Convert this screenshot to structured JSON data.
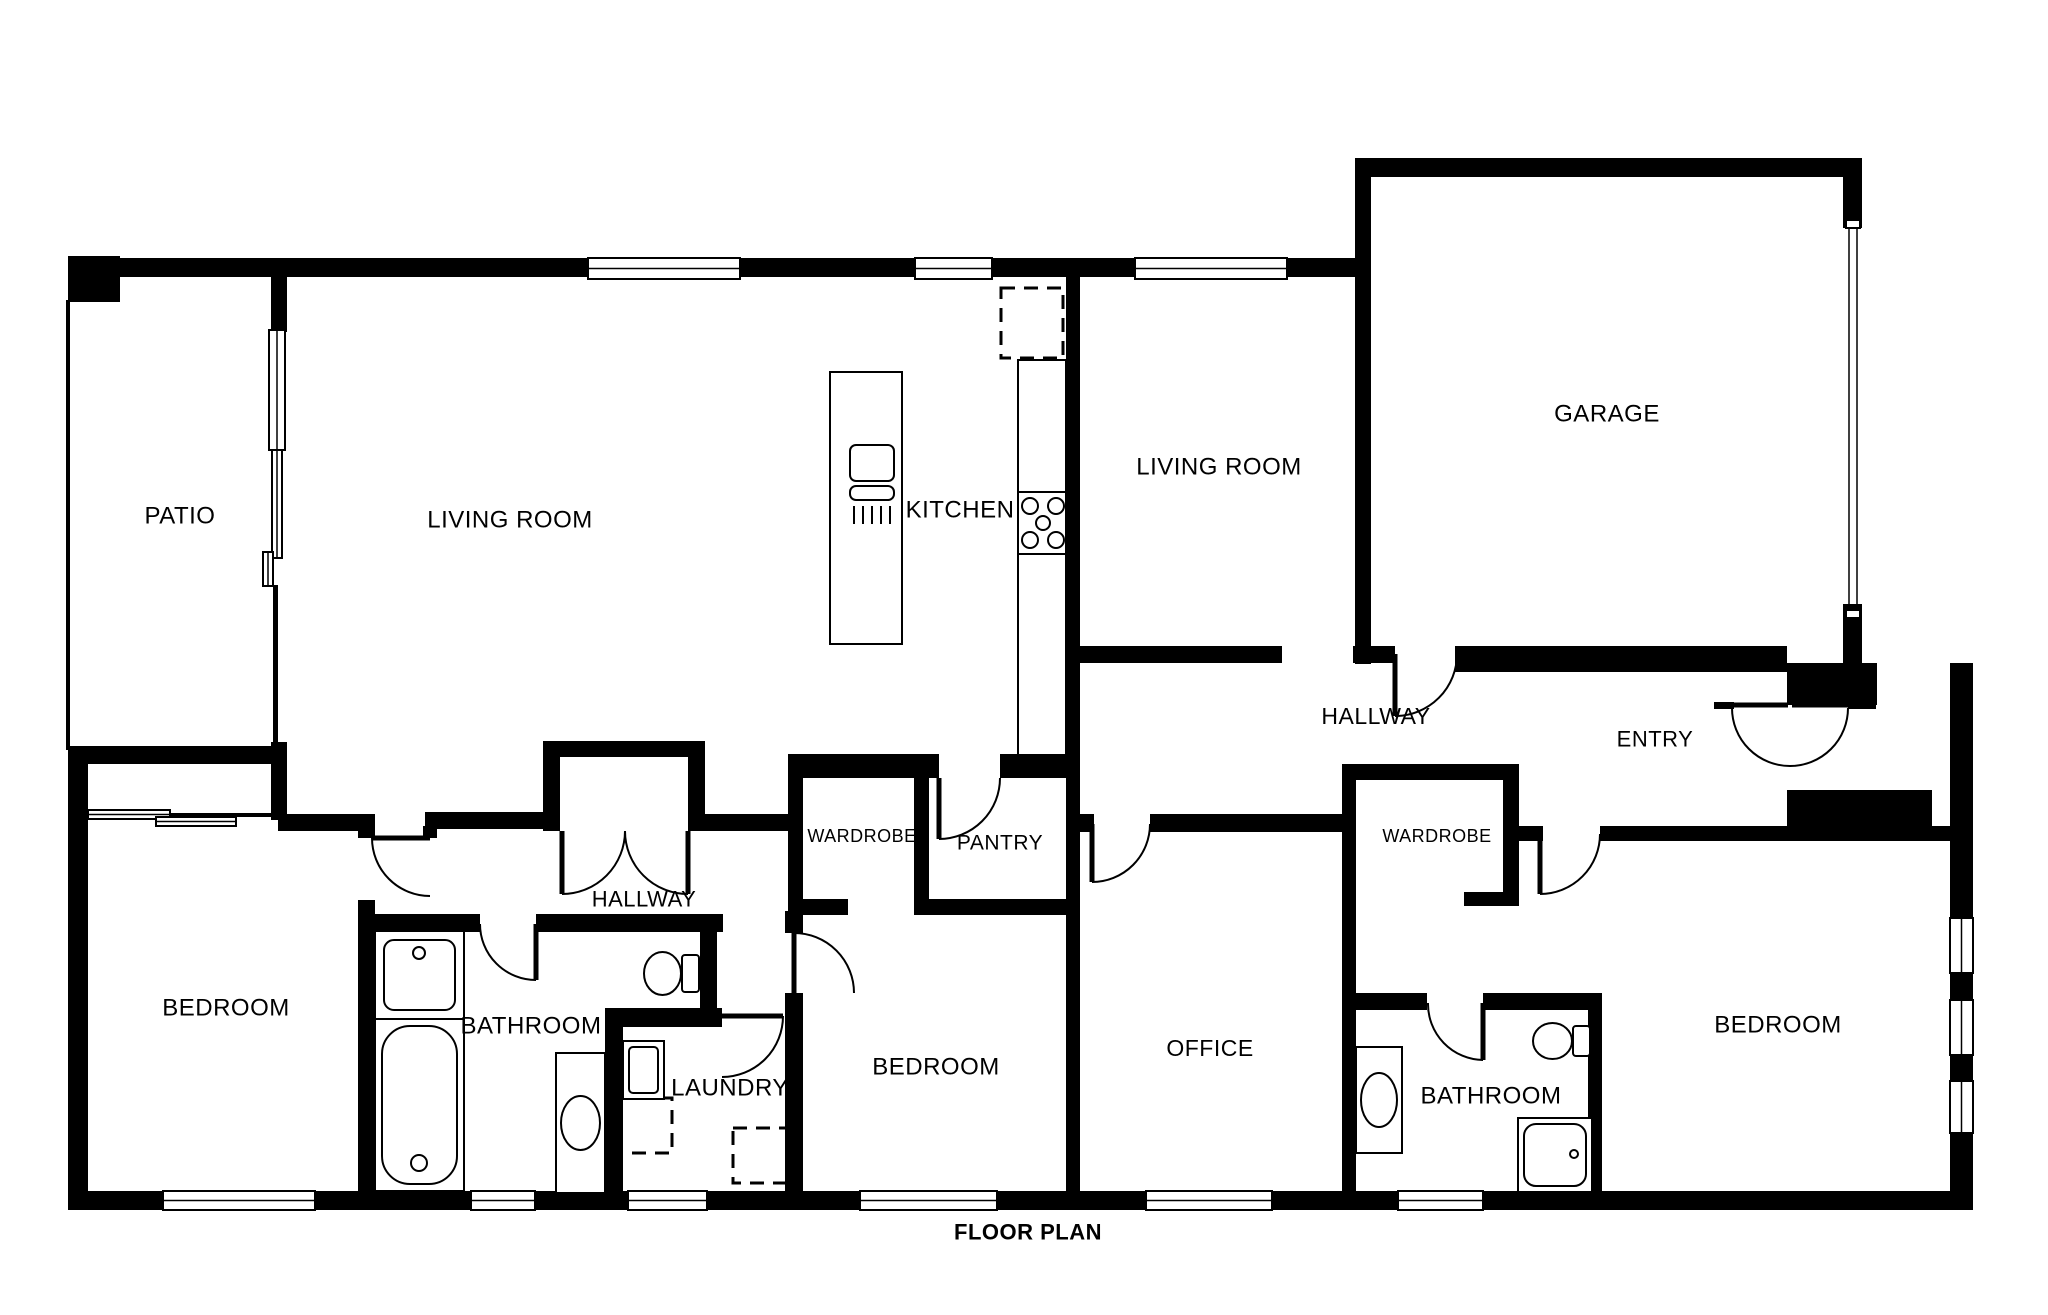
{
  "title": "FLOOR PLAN",
  "canvas": {
    "width": 2048,
    "height": 1315,
    "background": "#ffffff",
    "wall_color": "#000000",
    "line_color": "#000000"
  },
  "rooms": [
    {
      "id": "patio",
      "label": "PATIO",
      "x": 180,
      "y": 516,
      "size": 24,
      "bold": false
    },
    {
      "id": "living-room-1",
      "label": "LIVING ROOM",
      "x": 510,
      "y": 520,
      "size": 24,
      "bold": false
    },
    {
      "id": "kitchen",
      "label": "KITCHEN",
      "x": 960,
      "y": 510,
      "size": 24,
      "bold": false
    },
    {
      "id": "living-room-2",
      "label": "LIVING ROOM",
      "x": 1219,
      "y": 467,
      "size": 24,
      "bold": false
    },
    {
      "id": "garage",
      "label": "GARAGE",
      "x": 1607,
      "y": 414,
      "size": 24,
      "bold": false
    },
    {
      "id": "hallway-top",
      "label": "HALLWAY",
      "x": 1376,
      "y": 716,
      "size": 23,
      "bold": false
    },
    {
      "id": "entry",
      "label": "ENTRY",
      "x": 1655,
      "y": 739,
      "size": 22,
      "bold": false
    },
    {
      "id": "wardrobe-left",
      "label": "WARDROBE",
      "x": 862,
      "y": 836,
      "size": 18,
      "bold": false
    },
    {
      "id": "pantry",
      "label": "PANTRY",
      "x": 1000,
      "y": 843,
      "size": 21,
      "bold": false
    },
    {
      "id": "wardrobe-right",
      "label": "WARDROBE",
      "x": 1437,
      "y": 836,
      "size": 18,
      "bold": false
    },
    {
      "id": "hallway-lower",
      "label": "HALLWAY",
      "x": 644,
      "y": 899,
      "size": 22,
      "bold": false
    },
    {
      "id": "bedroom-left",
      "label": "BEDROOM",
      "x": 226,
      "y": 1008,
      "size": 24,
      "bold": false
    },
    {
      "id": "bathroom-left",
      "label": "BATHROOM",
      "x": 531,
      "y": 1026,
      "size": 24,
      "bold": false
    },
    {
      "id": "laundry",
      "label": "LAUNDRY",
      "x": 730,
      "y": 1088,
      "size": 24,
      "bold": false
    },
    {
      "id": "bedroom-middle",
      "label": "BEDROOM",
      "x": 936,
      "y": 1067,
      "size": 24,
      "bold": false
    },
    {
      "id": "office",
      "label": "OFFICE",
      "x": 1210,
      "y": 1048,
      "size": 23,
      "bold": false
    },
    {
      "id": "bathroom-right",
      "label": "BATHROOM",
      "x": 1491,
      "y": 1096,
      "size": 24,
      "bold": false
    },
    {
      "id": "bedroom-right",
      "label": "BEDROOM",
      "x": 1778,
      "y": 1025,
      "size": 24,
      "bold": false
    },
    {
      "id": "plan-title",
      "label": "FLOOR PLAN",
      "x": 1028,
      "y": 1232,
      "size": 22,
      "bold": true
    }
  ],
  "walls": [
    [
      68,
      256,
      52,
      46
    ],
    [
      68,
      258,
      222,
      19
    ],
    [
      273,
      258,
      1097,
      19
    ],
    [
      1355,
      158,
      507,
      19
    ],
    [
      1355,
      158,
      16,
      506
    ],
    [
      1843,
      158,
      19,
      70
    ],
    [
      1843,
      604,
      19,
      62
    ],
    [
      1950,
      663,
      23,
      545
    ],
    [
      1787,
      663,
      90,
      42
    ],
    [
      1952,
      663,
      21,
      42
    ],
    [
      68,
      1191,
      1905,
      19
    ],
    [
      68,
      748,
      20,
      460
    ],
    [
      68,
      746,
      212,
      18
    ],
    [
      271,
      258,
      16,
      74
    ],
    [
      271,
      742,
      16,
      78
    ],
    [
      278,
      814,
      90,
      17
    ],
    [
      425,
      812,
      120,
      17
    ],
    [
      543,
      741,
      17,
      90
    ],
    [
      543,
      741,
      162,
      16
    ],
    [
      688,
      741,
      17,
      90
    ],
    [
      688,
      814,
      102,
      17
    ],
    [
      358,
      814,
      17,
      24
    ],
    [
      358,
      900,
      17,
      295
    ],
    [
      358,
      914,
      122,
      18
    ],
    [
      536,
      914,
      187,
      18
    ],
    [
      700,
      914,
      17,
      106
    ],
    [
      605,
      1008,
      117,
      19
    ],
    [
      605,
      1008,
      18,
      185
    ],
    [
      785,
      911,
      18,
      22
    ],
    [
      785,
      993,
      18,
      200
    ],
    [
      788,
      754,
      151,
      24
    ],
    [
      1000,
      754,
      80,
      24
    ],
    [
      788,
      754,
      15,
      161
    ],
    [
      914,
      754,
      15,
      161
    ],
    [
      788,
      899,
      60,
      16
    ],
    [
      914,
      899,
      166,
      16
    ],
    [
      1066,
      277,
      14,
      918
    ],
    [
      1080,
      814,
      14,
      18
    ],
    [
      1150,
      814,
      192,
      18
    ],
    [
      1342,
      764,
      14,
      431
    ],
    [
      1342,
      764,
      177,
      16
    ],
    [
      1503,
      764,
      16,
      142
    ],
    [
      1464,
      892,
      55,
      14
    ],
    [
      1517,
      826,
      26,
      15
    ],
    [
      1600,
      826,
      352,
      15
    ],
    [
      1356,
      993,
      71,
      17
    ],
    [
      1483,
      993,
      119,
      17
    ],
    [
      1588,
      993,
      14,
      202
    ],
    [
      1080,
      646,
      202,
      17
    ],
    [
      1353,
      646,
      42,
      17
    ],
    [
      1455,
      646,
      332,
      26
    ],
    [
      1787,
      790,
      145,
      38
    ],
    [
      423,
      826,
      14,
      12
    ]
  ],
  "thin_walls": [
    [
      66,
      300,
      4,
      450
    ],
    [
      273,
      585,
      5,
      160
    ],
    [
      88,
      813,
      185,
      4
    ],
    [
      1714,
      702,
      20,
      7
    ],
    [
      1848,
      702,
      28,
      7
    ]
  ],
  "windows": [
    {
      "x": 588,
      "y": 258,
      "w": 152,
      "h": 21,
      "orient": "h"
    },
    {
      "x": 915,
      "y": 258,
      "w": 77,
      "h": 21,
      "orient": "h"
    },
    {
      "x": 1135,
      "y": 258,
      "w": 152,
      "h": 21,
      "orient": "h"
    },
    {
      "x": 163,
      "y": 1191,
      "w": 152,
      "h": 19,
      "orient": "h"
    },
    {
      "x": 471,
      "y": 1191,
      "w": 64,
      "h": 19,
      "orient": "h"
    },
    {
      "x": 628,
      "y": 1191,
      "w": 79,
      "h": 19,
      "orient": "h"
    },
    {
      "x": 860,
      "y": 1191,
      "w": 137,
      "h": 19,
      "orient": "h"
    },
    {
      "x": 1146,
      "y": 1191,
      "w": 126,
      "h": 19,
      "orient": "h"
    },
    {
      "x": 1398,
      "y": 1191,
      "w": 85,
      "h": 19,
      "orient": "h"
    },
    {
      "x": 1950,
      "y": 918,
      "w": 23,
      "h": 55,
      "orient": "v"
    },
    {
      "x": 1950,
      "y": 1000,
      "w": 23,
      "h": 55,
      "orient": "v"
    },
    {
      "x": 1950,
      "y": 1081,
      "w": 23,
      "h": 52,
      "orient": "v"
    },
    {
      "x": 269,
      "y": 330,
      "w": 16,
      "h": 120,
      "orient": "v"
    },
    {
      "x": 272,
      "y": 450,
      "w": 10,
      "h": 108,
      "orient": "v"
    },
    {
      "x": 263,
      "y": 552,
      "w": 10,
      "h": 34,
      "orient": "v"
    },
    {
      "x": 88,
      "y": 810,
      "w": 82,
      "h": 9,
      "orient": "h"
    },
    {
      "x": 156,
      "y": 817,
      "w": 80,
      "h": 9,
      "orient": "h"
    }
  ],
  "doors": [
    {
      "name": "bedroom-left-door",
      "leaf": [
        430,
        838,
        372,
        838
      ],
      "arc": "M 372 838 A 58 58 0 0 0 430 896"
    },
    {
      "name": "bathroom-left-door",
      "leaf": [
        536,
        924,
        536,
        980
      ],
      "arc": "M 480 924 A 56 56 0 0 0 536 980"
    },
    {
      "name": "hall-double-door-l",
      "leaf": [
        562,
        831,
        562,
        894
      ],
      "arc": "M 625 831 A 63 63 0 0 1 562 894"
    },
    {
      "name": "hall-double-door-r",
      "leaf": [
        688,
        831,
        688,
        894
      ],
      "arc": "M 625 831 A 63 63 0 0 0 688 894"
    },
    {
      "name": "pantry-door",
      "leaf": [
        939,
        778,
        939,
        839
      ],
      "arc": "M 1000 778 A 61 61 0 0 1 939 839"
    },
    {
      "name": "bedroom-middle-door",
      "leaf": [
        794,
        993,
        794,
        933
      ],
      "arc": "M 794 933 A 60 60 0 0 1 854 993"
    },
    {
      "name": "laundry-door",
      "leaf": [
        722,
        1016,
        783,
        1016
      ],
      "arc": "M 783 1016 A 61 61 0 0 1 722 1077"
    },
    {
      "name": "office-door",
      "leaf": [
        1092,
        824,
        1092,
        882
      ],
      "arc": "M 1150 824 A 58 58 0 0 1 1092 882"
    },
    {
      "name": "garage-hall-door",
      "leaf": [
        1395,
        654,
        1395,
        716
      ],
      "arc": "M 1457 654 A 62 62 0 0 1 1395 716"
    },
    {
      "name": "entry-double-door",
      "leaf": [
        1732,
        705,
        1788,
        705
      ],
      "arc": "M 1732 708 A 58 58 0 0 0 1848 708"
    },
    {
      "name": "entry-double-door-2",
      "leaf": [
        1792,
        705,
        1848,
        705
      ],
      "arc": ""
    },
    {
      "name": "bedroom-right-door",
      "leaf": [
        1540,
        834,
        1540,
        894
      ],
      "arc": "M 1600 834 A 60 60 0 0 1 1540 894"
    },
    {
      "name": "bathroom-right-door",
      "leaf": [
        1483,
        1003,
        1483,
        1060
      ],
      "arc": "M 1428 1003 A 56 56 0 0 0 1483 1060"
    }
  ],
  "fixtures": [
    {
      "type": "island",
      "name": "kitchen-island",
      "x": 830,
      "y": 372,
      "w": 72,
      "h": 272
    },
    {
      "type": "island_sink",
      "name": "kitchen-sink",
      "x": 850,
      "y": 445,
      "w": 44,
      "h": 80
    },
    {
      "type": "counter",
      "name": "kitchen-counter",
      "x": 1018,
      "y": 360,
      "w": 48,
      "h": 395
    },
    {
      "type": "stove",
      "name": "stove",
      "x": 1018,
      "y": 492,
      "w": 48,
      "h": 62
    },
    {
      "type": "dashed_box",
      "name": "fridge-space",
      "x": 1001,
      "y": 288,
      "w": 62,
      "h": 70
    },
    {
      "type": "dashed_box",
      "name": "washer-space",
      "x": 615,
      "y": 1098,
      "w": 57,
      "h": 55
    },
    {
      "type": "dashed_box",
      "name": "dryer-space",
      "x": 733,
      "y": 1128,
      "w": 57,
      "h": 55
    },
    {
      "type": "sink_square",
      "name": "bathroom-left-sink",
      "x": 375,
      "y": 931,
      "w": 89,
      "h": 88
    },
    {
      "type": "bathtub",
      "name": "bathtub",
      "x": 375,
      "y": 1019,
      "w": 89,
      "h": 172
    },
    {
      "type": "toilet",
      "name": "toilet-left",
      "x": 643,
      "y": 951,
      "w": 56,
      "h": 45
    },
    {
      "type": "vanity",
      "name": "bathroom-left-vanity",
      "x": 556,
      "y": 1053,
      "w": 49,
      "h": 140
    },
    {
      "type": "laundry_sink",
      "name": "laundry-sink",
      "x": 623,
      "y": 1041,
      "w": 41,
      "h": 58
    },
    {
      "type": "toilet",
      "name": "toilet-right",
      "x": 1532,
      "y": 1022,
      "w": 58,
      "h": 38
    },
    {
      "type": "vanity",
      "name": "bathroom-right-vanity",
      "x": 1356,
      "y": 1047,
      "w": 46,
      "h": 106
    },
    {
      "type": "shower",
      "name": "shower",
      "x": 1518,
      "y": 1118,
      "w": 74,
      "h": 74
    },
    {
      "type": "garage_door",
      "name": "garage-door",
      "x": 1849,
      "y": 228,
      "w": 8,
      "h": 382
    }
  ]
}
